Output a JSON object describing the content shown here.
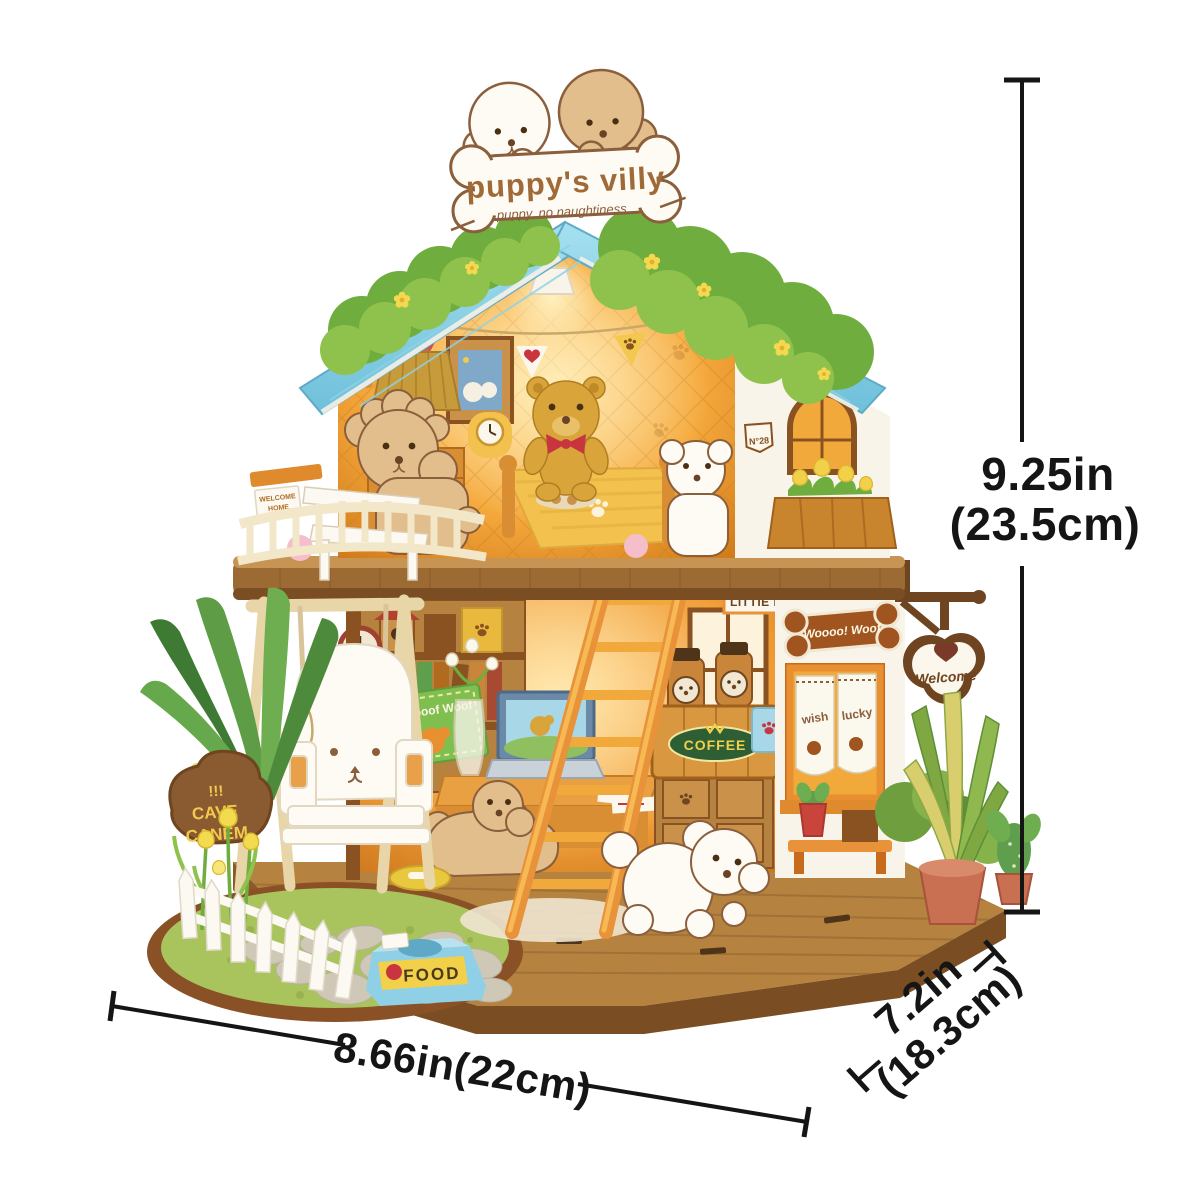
{
  "sign": {
    "title": "puppy's villy",
    "subtitle": "puppy, no naughtiness..."
  },
  "annotations": {
    "height_in": "9.25in",
    "height_cm": "(23.5cm)",
    "width": "8.66in(22cm)",
    "depth_in": "7.2in",
    "depth_cm": "(18.3cm)"
  },
  "labels": {
    "bone_sign": "Woooo! Woof",
    "welcome_sign": "Welcome",
    "coffee": "COFFEE",
    "food": "FOOD",
    "little_sign": "LITTIE P",
    "house_number": "N°28",
    "book_cover": "Woooof Woof",
    "curtain_left": "wish",
    "curtain_right": "lucky",
    "rock_marks": "!!!",
    "rock_line1": "CAVE",
    "rock_line2": "CANEM",
    "balcony_card_line1": "WELCOME",
    "balcony_card_line2": "HOME"
  },
  "colors": {
    "roof_blue": "#7CC8DE",
    "bush_green": "#7FB547",
    "wall_cream": "#F7F2E6",
    "interior_glow": "#F5A93C",
    "wood_brown": "#8A5A2A",
    "deck_tan": "#B5823F",
    "bowl_blue": "#8FD0E6",
    "grass_green": "#A9C35D",
    "dimension_black": "#151515"
  }
}
